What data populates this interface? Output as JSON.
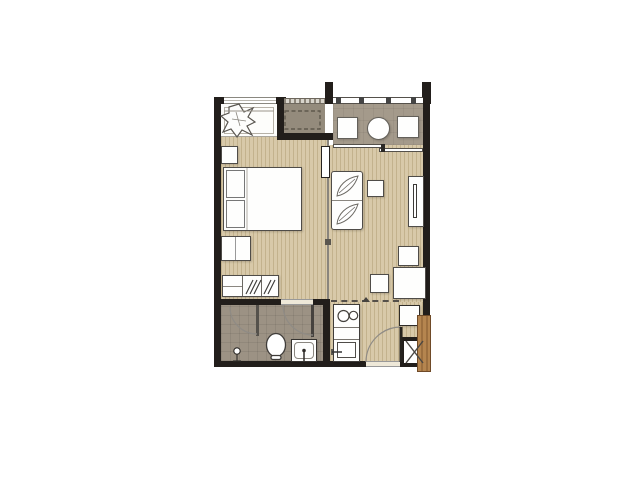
{
  "scene": {
    "type": "apartment-floor-plan",
    "unit_layout": "one-bedroom",
    "text_on_image": "none",
    "rooms": [
      {
        "name": "bedroom",
        "items": [
          "double-bed",
          "pillow",
          "pillow",
          "nightstand",
          "bedside-bench",
          "dresser-console-with-hatched-drawers"
        ]
      },
      {
        "name": "wardrobe-nook",
        "items": [
          "hanging-clothes",
          "closet-rod",
          "top-window"
        ]
      },
      {
        "name": "ac-ledge",
        "items": [
          "condenser-slot-dashed",
          "louver-strip"
        ]
      },
      {
        "name": "balcony",
        "items": [
          "railing",
          "planter-left",
          "washing-machine",
          "planter-right",
          "sliding-glass-door"
        ]
      },
      {
        "name": "living-room",
        "items": [
          "loveseat-sofa-leaf-cushions",
          "side-table",
          "tv-console",
          "television",
          "stool",
          "stool",
          "dining-table",
          "sliding-partition-panel"
        ]
      },
      {
        "name": "kitchen-entry",
        "items": [
          "two-burner-stove",
          "counter",
          "kitchen-sink",
          "shoe-cabinet",
          "entrance-door-swing",
          "pipe-shaft-x",
          "wood-door-leaf"
        ]
      },
      {
        "name": "bathroom",
        "items": [
          "shower-partition",
          "shower-door-swing",
          "shower-head",
          "toilet",
          "vanity-basin",
          "bathroom-door-swing"
        ]
      }
    ]
  },
  "colors": {
    "wall": "#221e1b",
    "wood": "#d8c9a9",
    "wood-stripe": "#c3b28d",
    "terrace": "#a49a8b",
    "ac-floor": "#948b7c",
    "bath": "#9c9284",
    "furn-fill": "#fefefd",
    "furn-border": "#4f4c48",
    "arc": "#8f8b85",
    "dash": "#55504a",
    "door-wood": "#ad7b4e",
    "door-wood-edge": "#6f4a28",
    "window-line": "#8a8880",
    "threshold": "#eee8d8"
  }
}
